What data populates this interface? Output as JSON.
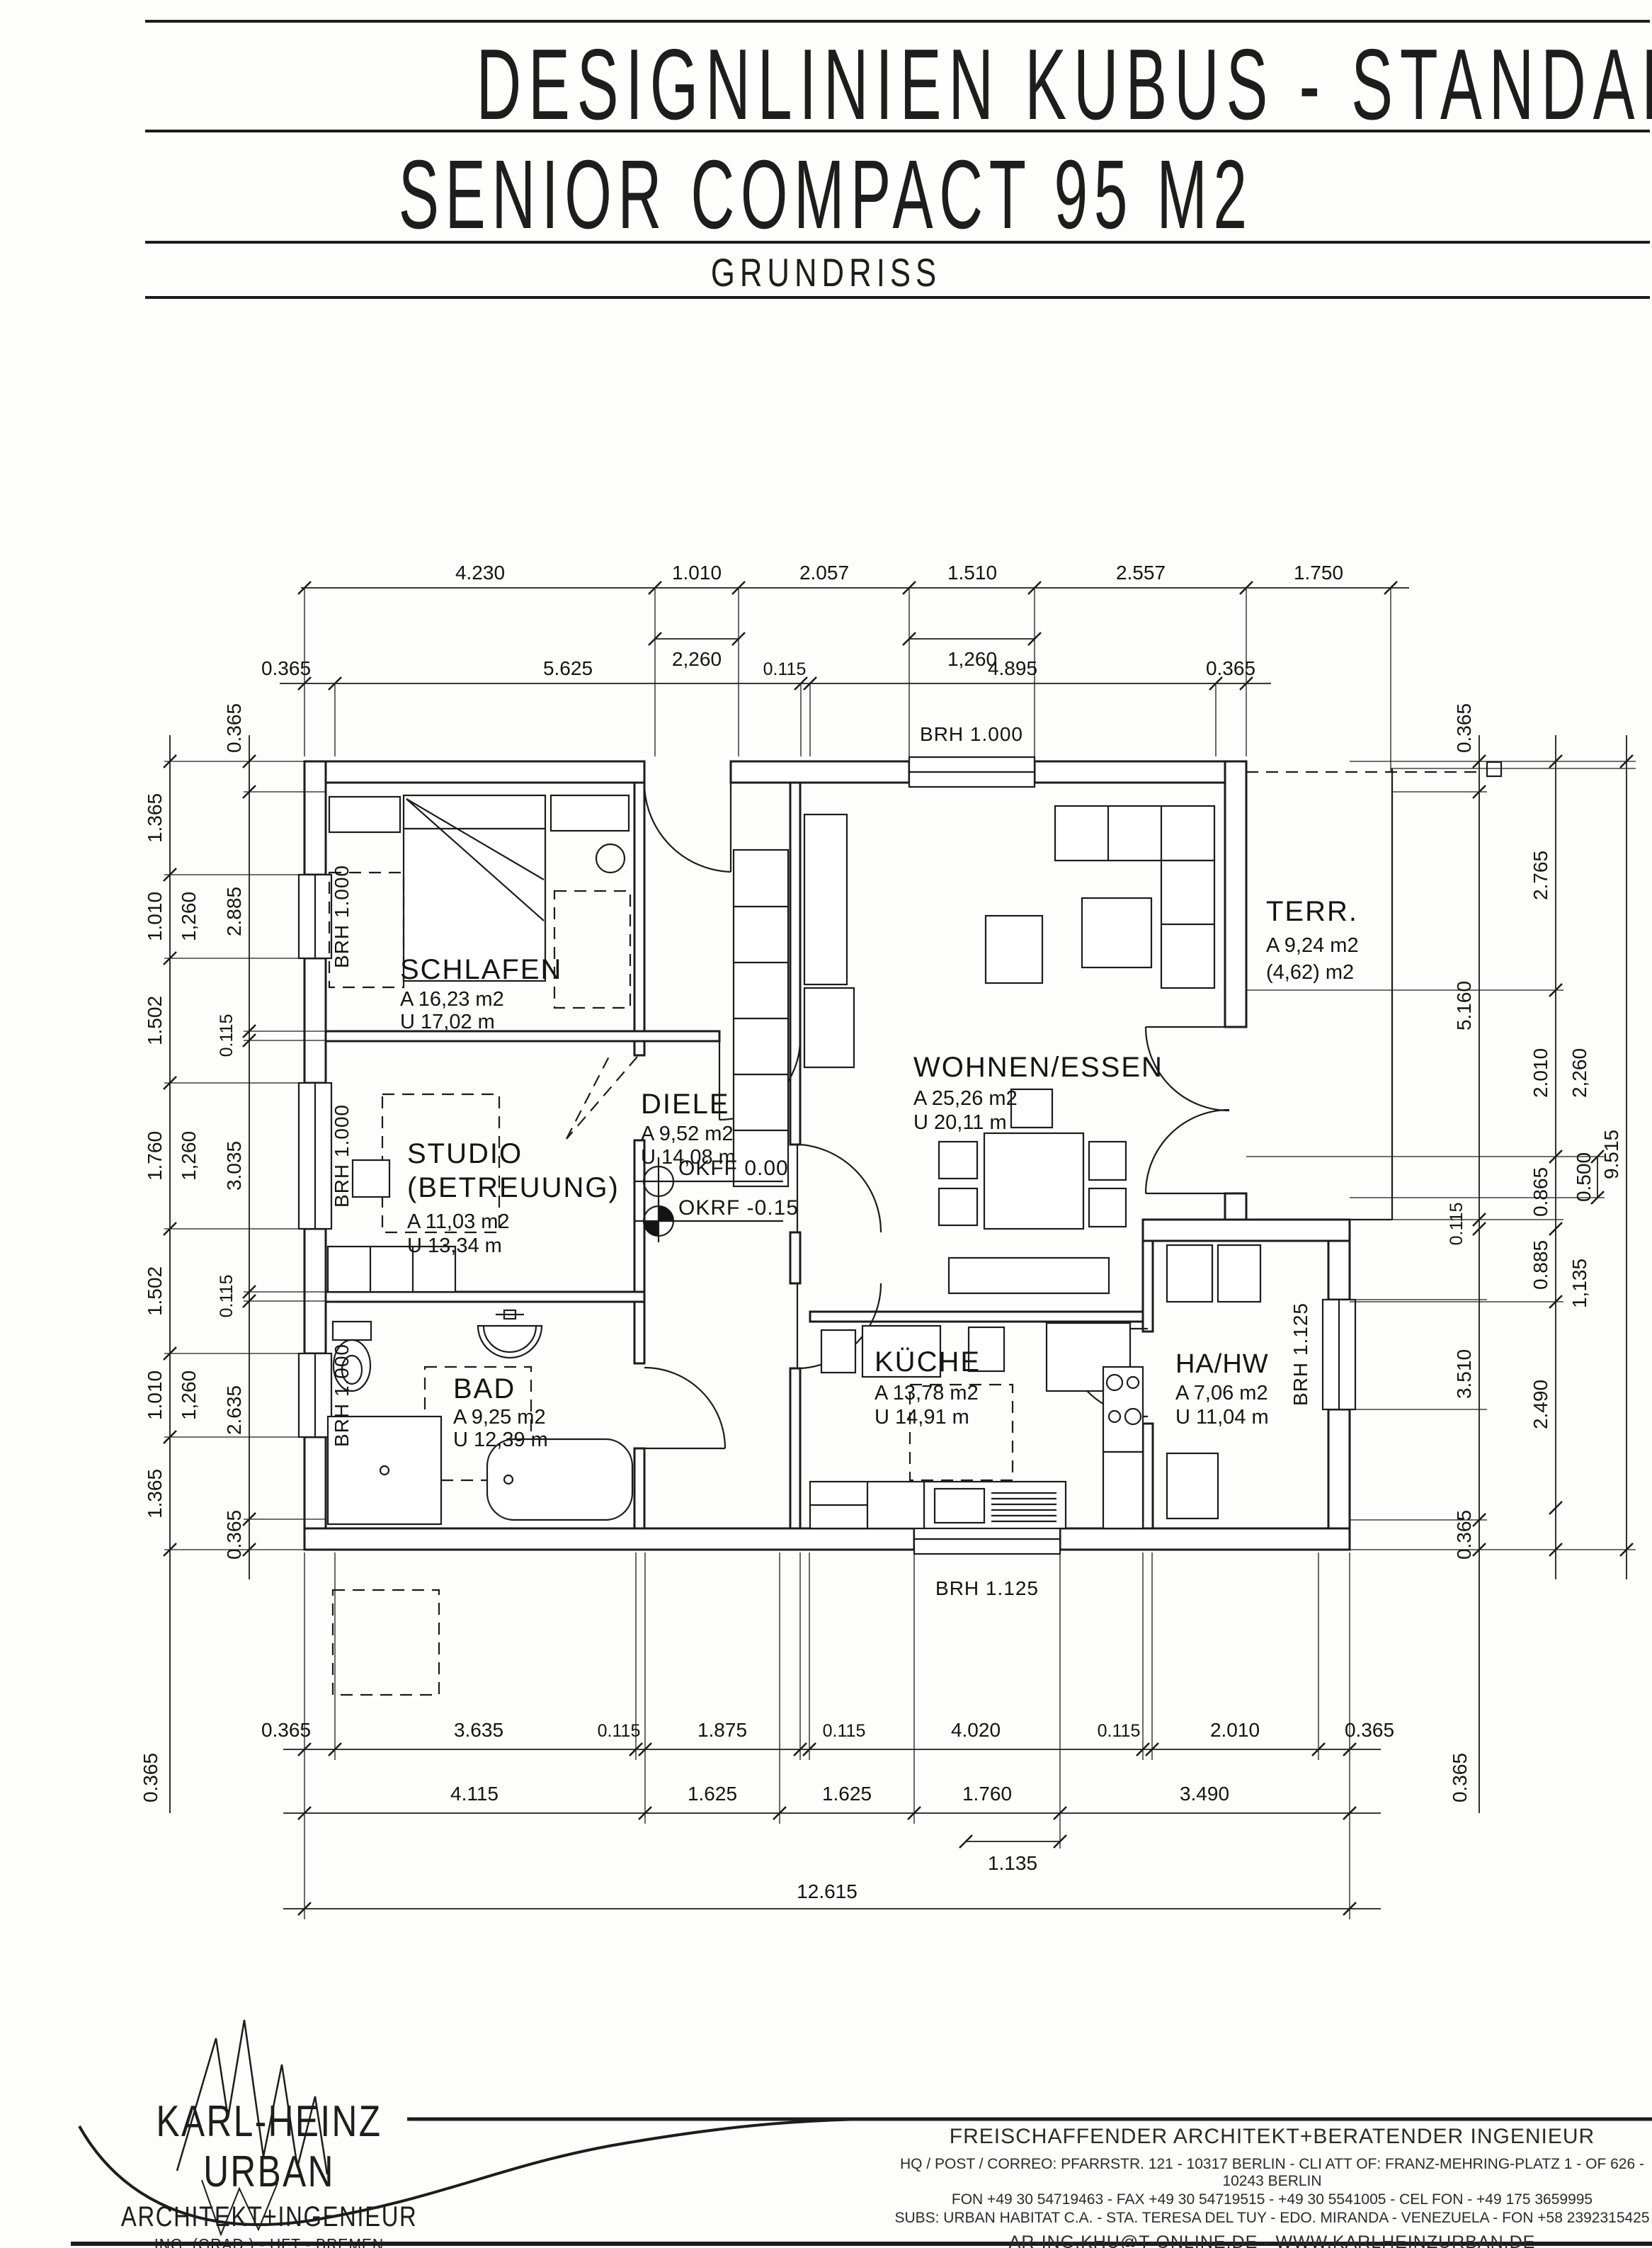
{
  "header": {
    "title": "DESIGNLINIEN KUBUS - STANDARD - NEON",
    "subtitle": "SENIOR COMPACT 95 M2",
    "drawing_type": "GRUNDRISS"
  },
  "rooms": {
    "schlafen": {
      "name": "SCHLAFEN",
      "area": "A 16,23 m2",
      "perimeter": "U 17,02 m"
    },
    "studio": {
      "name": "STUDIO",
      "name2": "(BETREUUNG)",
      "area": "A 11,03 m2",
      "perimeter": "U 13,34 m"
    },
    "bad": {
      "name": "BAD",
      "area": "A 9,25 m2",
      "perimeter": "U 12,39 m"
    },
    "diele": {
      "name": "DIELE",
      "area": "A 9,52 m2",
      "perimeter": "U 14,08 m"
    },
    "wohnen": {
      "name": "WOHNEN/ESSEN",
      "area": "A 25,26 m2",
      "perimeter": "U 20,11 m"
    },
    "kueche": {
      "name": "KÜCHE",
      "area": "A 13,78 m2",
      "perimeter": "U 14,91 m"
    },
    "hahw": {
      "name": "HA/HW",
      "area": "A 7,06 m2",
      "perimeter": "U 11,04 m"
    },
    "terrasse": {
      "name": "TERR.",
      "area": "A 9,24 m2",
      "area2": "(4,62) m2"
    }
  },
  "levels": {
    "okff": "OKFF 0.00",
    "okrf": "OKRF -0.15"
  },
  "sills": {
    "top": "BRH 1.000",
    "left1": "BRH 1.000",
    "left2": "BRH 1.000",
    "left3": "BRH 1.000",
    "right": "BRH 1.125",
    "bottom": "BRH 1.125"
  },
  "dims": {
    "top1": [
      "4.230",
      "1.010",
      "2.057",
      "1.510",
      "2.557",
      "1.750"
    ],
    "top_sub": [
      "2,260",
      "1,260"
    ],
    "top2": [
      "0.365",
      "5.625",
      "0.115",
      "4.895",
      "0.365"
    ],
    "left_outer": [
      "1.365",
      "1.010",
      "1.502",
      "1.760",
      "1.502",
      "1.010",
      "1.365"
    ],
    "left_sub": [
      "1,260",
      "1,260",
      "1,260"
    ],
    "left_inner": [
      "0.365",
      "2.885",
      "0.115",
      "3.035",
      "0.115",
      "2.635",
      "0.365"
    ],
    "right_inner": [
      "0.365",
      "5.160",
      "0.115",
      "3.510",
      "0.365"
    ],
    "right_mid": [
      "2.765",
      "2.010",
      "0.865",
      "0.885",
      "2.490"
    ],
    "right_sub": [
      "2,260",
      "0.500",
      "1,135"
    ],
    "right_total": "9.515",
    "bottom1": [
      "0.365",
      "3.635",
      "0.115",
      "1.875",
      "0.115",
      "4.020",
      "0.115",
      "2.010",
      "0.365"
    ],
    "bottom_rot": [
      "0.365",
      "0.365"
    ],
    "bottom2": [
      "4.115",
      "1.625",
      "1.625",
      "1.760",
      "3.490"
    ],
    "bottom_sub": "1.135",
    "bottom_total": "12.615"
  },
  "footer": {
    "logo": {
      "name": "KARL-HEINZ URBAN",
      "subtitle": "ARCHITEKT+INGENIEUR",
      "lines": [
        "ING. (GRAD.) - HFT - BREMEN",
        "DIPLOMINGENIEUR - HFBK - HAMBURG",
        "ARQUITECTO - USB - CARACAS"
      ]
    },
    "office": {
      "headline": "FREISCHAFFENDER ARCHITEKT+BERATENDER INGENIEUR",
      "address": "HQ / POST / CORREO: PFARRSTR. 121 - 10317 BERLIN - CLI ATT OF: FRANZ-MEHRING-PLATZ 1 - OF 626 - 10243 BERLIN",
      "phone": "FON +49 30 54719463 - FAX +49 30 54719515 - +49 30 5541005 - CEL FON - +49 175 3659995",
      "subs": "SUBS: URBAN HABITAT C.A. - STA. TERESA DEL TUY - EDO. MIRANDA - VENEZUELA - FON +58 2392315425",
      "web": "AR-ING.KHU@T-ONLINE.DE  -  WWW.KARLHEINZURBAN.DE",
      "role1": "PLANUNG",
      "role2": "BAULEITUNG"
    }
  }
}
